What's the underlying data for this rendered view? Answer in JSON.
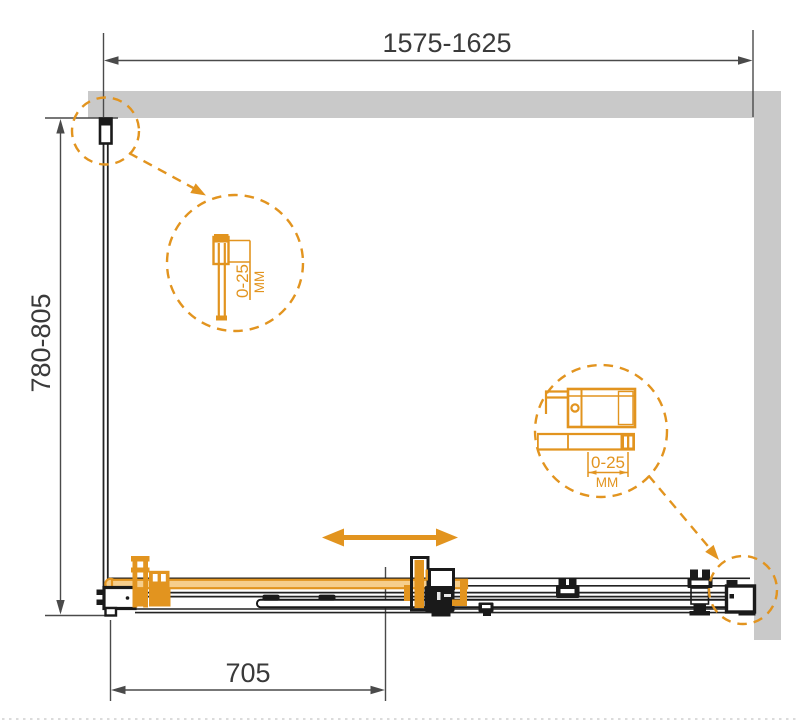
{
  "colors": {
    "accent": "#E2941F",
    "accent_light": "#F6CE8C",
    "wall": "#C9C9C9",
    "hardware": "#1A1A1A",
    "dim_line": "#4A4A4A",
    "ink": "#3A3A3A"
  },
  "dimensions": {
    "overall_width": "1575-1625",
    "side_depth": "780-805",
    "door_width": "705"
  },
  "details": {
    "wall_profile": {
      "range": "0-25",
      "unit": "MM"
    },
    "roller_bracket": {
      "range": "0-25",
      "unit": "MM"
    }
  }
}
